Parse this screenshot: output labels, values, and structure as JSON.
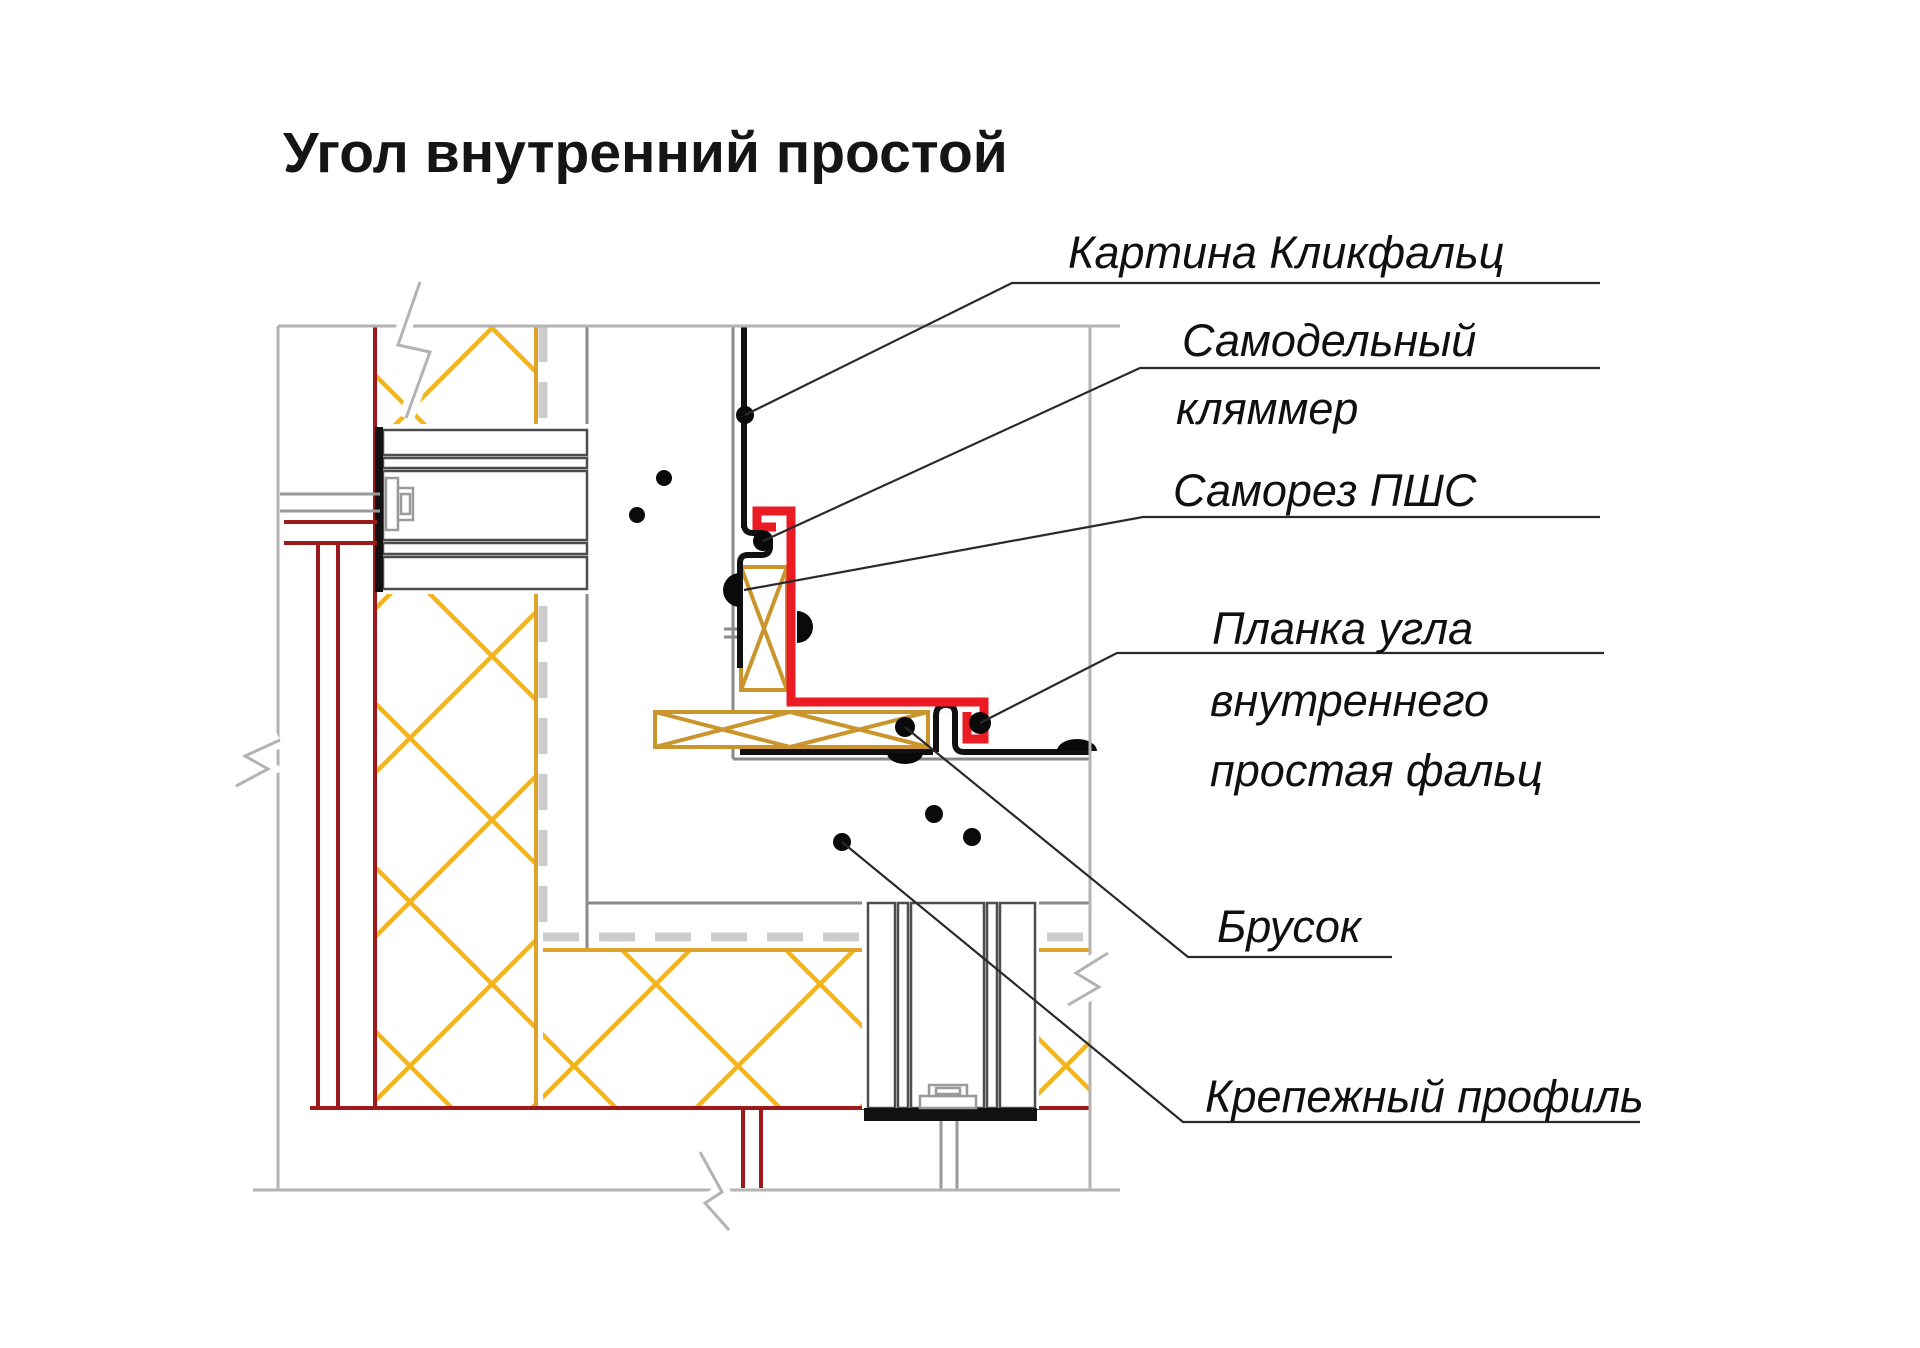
{
  "title": "Угол внутренний простой",
  "callouts": [
    {
      "id": "klickfalz-panel",
      "lines": [
        "Картина Кликфальц"
      ]
    },
    {
      "id": "homemade-clamp",
      "lines": [
        "Самодельный",
        "кляммер"
      ]
    },
    {
      "id": "screw-pshs",
      "lines": [
        "Саморез ПШС"
      ]
    },
    {
      "id": "inner-corner-strip",
      "lines": [
        "Планка угла",
        "внутреннего",
        "простая фальц"
      ]
    },
    {
      "id": "timber-block",
      "lines": [
        "Брусок"
      ]
    },
    {
      "id": "fastening-profile",
      "lines": [
        "Крепежный профиль"
      ]
    }
  ],
  "colors": {
    "corner_strip_red": "#ea1b22",
    "membrane_dark_red": "#9e1a1a",
    "insulation_hatch_gold": "#f3b41c",
    "timber_tan": "#c9952c",
    "structure_gray": "#b3b3b3",
    "detail_gray": "#4d4d4d",
    "panel_black": "#111111"
  }
}
